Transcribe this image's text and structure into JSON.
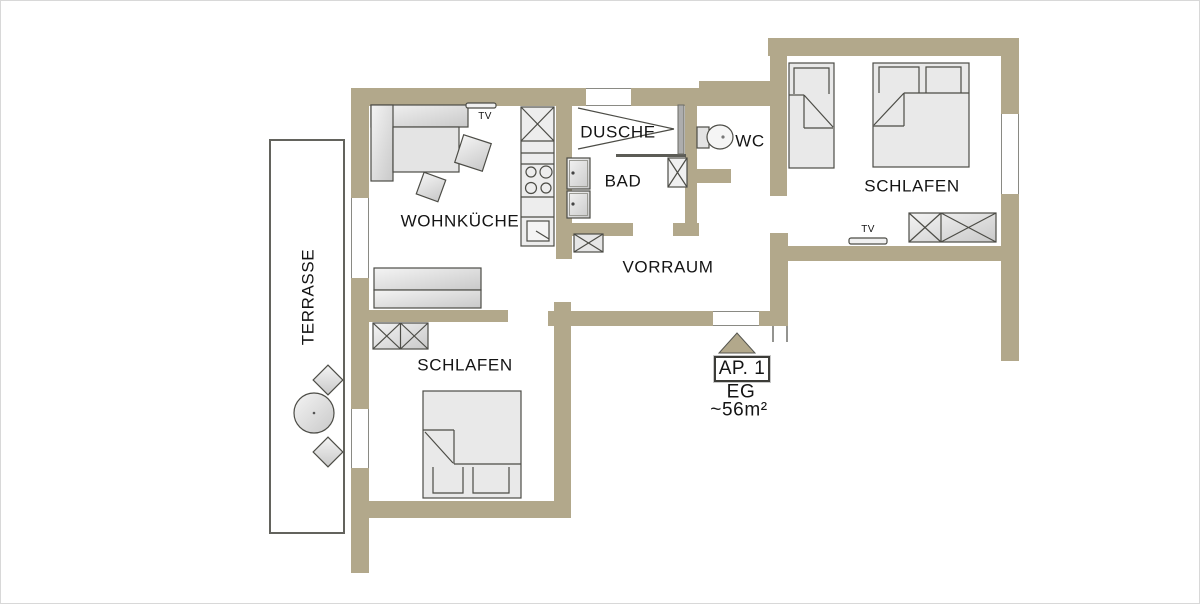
{
  "rooms": {
    "living_kitchen": "WOHNKÜCHE",
    "shower": "DUSCHE",
    "bath": "BAD",
    "wc": "WC",
    "hall": "VORRAUM",
    "bedroom_right": "SCHLAFEN",
    "bedroom_left": "SCHLAFEN",
    "terrace": "TERRASSE"
  },
  "labels": {
    "tv": "TV",
    "apartment_id": "AP. 1",
    "floor": "EG",
    "area": "~56m²"
  },
  "colors": {
    "wall": "#b2a88b",
    "outline": "#4c4c46",
    "furniture": "#e9e9e9",
    "text": "#141414"
  }
}
